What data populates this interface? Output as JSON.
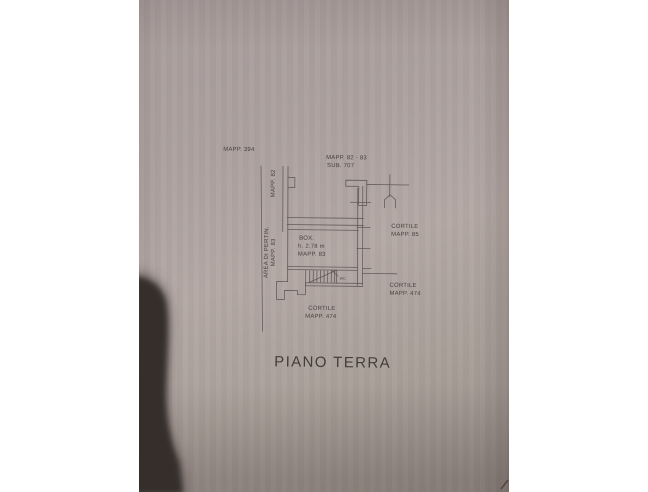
{
  "photo": {
    "margin_color": "#ffffff",
    "paper_color": "#aea3a0",
    "line_color": "#56504d",
    "text_color": "#3e3835",
    "shadow_color": "#352e2c"
  },
  "plan": {
    "parcel_top_left": "MAPP. 394",
    "parcel_top_right_line1": "MAPP. 82 - 83",
    "parcel_top_right_line2": "SUB. 707",
    "boundary_vertical_label": "MAPP. 82",
    "area_vertical_line1": "AREA DI PERTIN.",
    "area_vertical_line2": "MAPP. 83",
    "box_room_line1": "BOX.",
    "box_room_line2": "h. 2.78 m",
    "box_room_line3": "MAPP. 83",
    "courtyard_right_line1": "CORTILE",
    "courtyard_right_line2": "MAPP. 85",
    "courtyard_mid_right_line1": "CORTILE",
    "courtyard_mid_right_line2": "MAPP. 474",
    "courtyard_bottom_line1": "CORTILE",
    "courtyard_bottom_line2": "MAPP. 474",
    "wc_label": "WC",
    "floor_title": "PIANO TERRA"
  }
}
